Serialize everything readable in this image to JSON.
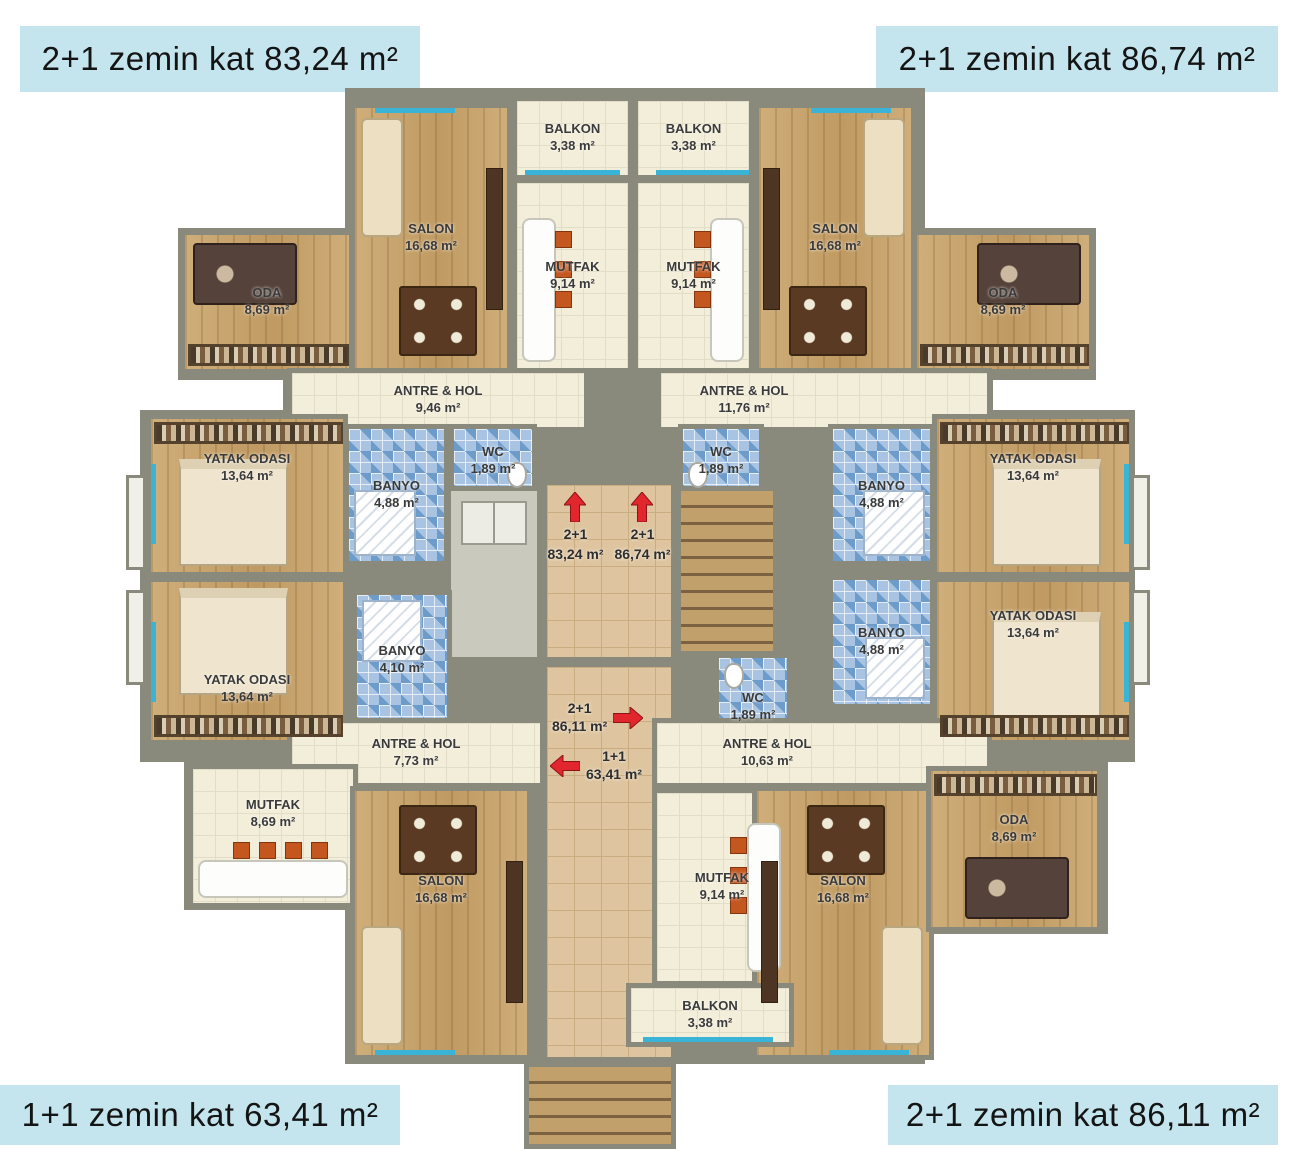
{
  "corner_labels": {
    "top_left": "2+1 zemin kat 83,24 m²",
    "top_right": "2+1 zemin kat 86,74 m²",
    "bottom_left": "1+1 zemin kat 63,41 m²",
    "bottom_right": "2+1 zemin kat 86,11 m²"
  },
  "rooms": {
    "balkon_nw": {
      "name": "BALKON",
      "area": "3,38 m²"
    },
    "balkon_ne": {
      "name": "BALKON",
      "area": "3,38 m²"
    },
    "balkon_s": {
      "name": "BALKON",
      "area": "3,38 m²"
    },
    "mutfak_nw": {
      "name": "MUTFAK",
      "area": "9,14 m²"
    },
    "mutfak_ne": {
      "name": "MUTFAK",
      "area": "9,14 m²"
    },
    "mutfak_s": {
      "name": "MUTFAK",
      "area": "9,14 m²"
    },
    "mutfak_sw": {
      "name": "MUTFAK",
      "area": "8,69 m²"
    },
    "salon_nw": {
      "name": "SALON",
      "area": "16,68 m²"
    },
    "salon_ne": {
      "name": "SALON",
      "area": "16,68 m²"
    },
    "salon_sw": {
      "name": "SALON",
      "area": "16,68 m²"
    },
    "salon_se": {
      "name": "SALON",
      "area": "16,68 m²"
    },
    "oda_nw": {
      "name": "ODA",
      "area": "8,69 m²"
    },
    "oda_ne": {
      "name": "ODA",
      "area": "8,69 m²"
    },
    "oda_se": {
      "name": "ODA",
      "area": "8,69 m²"
    },
    "antre_nw": {
      "name": "ANTRE & HOL",
      "area": "9,46 m²"
    },
    "antre_ne": {
      "name": "ANTRE & HOL",
      "area": "11,76 m²"
    },
    "antre_sw": {
      "name": "ANTRE & HOL",
      "area": "7,73 m²"
    },
    "antre_se": {
      "name": "ANTRE & HOL",
      "area": "10,63 m²"
    },
    "yatak_nw": {
      "name": "YATAK ODASI",
      "area": "13,64 m²"
    },
    "yatak_ne": {
      "name": "YATAK ODASI",
      "area": "13,64 m²"
    },
    "yatak_sw": {
      "name": "YATAK ODASI",
      "area": "13,64 m²"
    },
    "yatak_se": {
      "name": "YATAK ODASI",
      "area": "13,64 m²"
    },
    "banyo_nw": {
      "name": "BANYO",
      "area": "4,88 m²"
    },
    "banyo_ne": {
      "name": "BANYO",
      "area": "4,88 m²"
    },
    "banyo_se": {
      "name": "BANYO",
      "area": "4,88 m²"
    },
    "banyo_sw": {
      "name": "BANYO",
      "area": "4,10 m²"
    },
    "wc_nw": {
      "name": "WC",
      "area": "1,89 m²"
    },
    "wc_ne": {
      "name": "WC",
      "area": "1,89 m²"
    },
    "wc_se": {
      "name": "WC",
      "area": "1,89 m²"
    }
  },
  "markers": {
    "up_left": {
      "unit": "2+1",
      "area": "83,24 m²",
      "direction": "up"
    },
    "up_right": {
      "unit": "2+1",
      "area": "86,74 m²",
      "direction": "up"
    },
    "right": {
      "unit": "2+1",
      "area": "86,11 m²",
      "direction": "right"
    },
    "left": {
      "unit": "1+1",
      "area": "63,41 m²",
      "direction": "left"
    }
  },
  "colors": {
    "label_bg": "#c4e5ee",
    "wall": "#8a8a7c",
    "wood_floor": "#c7a36d",
    "cream_floor": "#f3eed9",
    "bath_tile": "#6d9bca",
    "hall_tile": "#dec5a0",
    "arrow_red": "#e1262d"
  }
}
